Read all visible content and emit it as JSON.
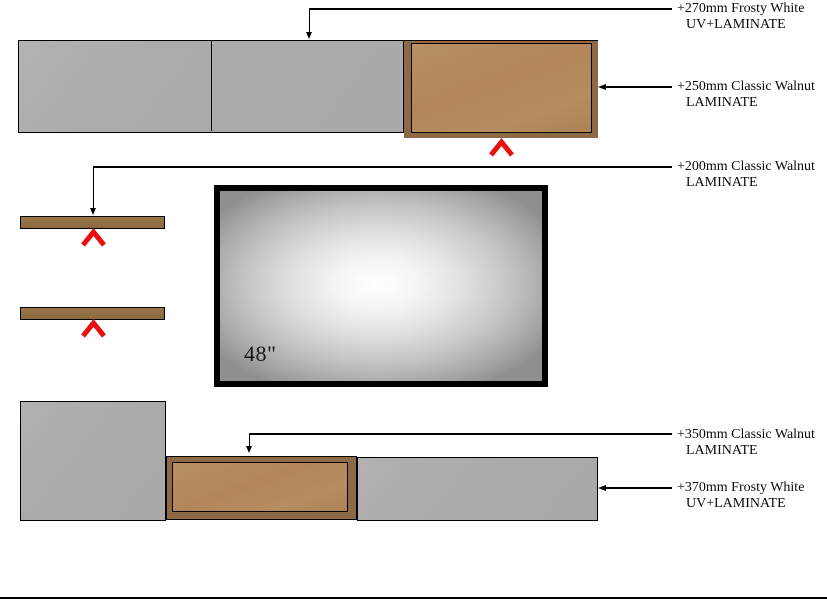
{
  "drawing_title": "Wall unit elevation",
  "tv": {
    "size_label": "48\""
  },
  "annotations": [
    {
      "id": "top-strip",
      "line1": "+270mm Frosty White",
      "line2": "UV+LAMINATE"
    },
    {
      "id": "top-cabinet",
      "line1": "+250mm Classic Walnut",
      "line2": "LAMINATE"
    },
    {
      "id": "shelves",
      "line1": "+200mm Classic Walnut",
      "line2": "LAMINATE"
    },
    {
      "id": "bottom-cabinet",
      "line1": "+350mm Classic Walnut",
      "line2": "LAMINATE"
    },
    {
      "id": "bottom-strip",
      "line1": "+370mm Frosty White",
      "line2": "UV+LAMINATE"
    }
  ],
  "colors": {
    "panel_gray": "#ababab",
    "walnut_frame": "#8d6a45",
    "walnut_panel": "#b28659",
    "shelf_brown": "#916e42",
    "marker_red": "#e90f0f",
    "line_black": "#000000"
  }
}
